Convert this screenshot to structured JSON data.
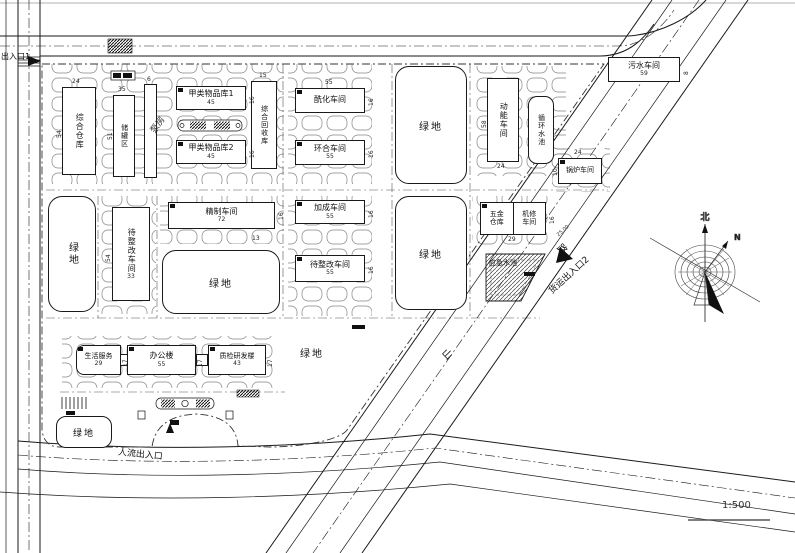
{
  "labels": {
    "green": "绿地",
    "scale": "1:500",
    "entrance1": "出入口1",
    "freight2": "货运出入口2",
    "pedestrian": "人流出入口",
    "road_char_shan": "山",
    "road_char_lu": "路",
    "elevation": "25.00",
    "north_char": "北",
    "north_n": "N",
    "emergency_pool": "应急水池"
  },
  "buildings": {
    "zonghecangku": {
      "name": "综合仓库",
      "w": "24",
      "h": "54"
    },
    "guanqu": {
      "name": "储罐区",
      "w": "35",
      "h": "51"
    },
    "bengfang": {
      "name": "泵房",
      "w": "6"
    },
    "jialei1": {
      "name": "甲类物品库1",
      "w": "45",
      "h": "16"
    },
    "jialei2": {
      "name": "甲类物品库2",
      "w": "45",
      "h": "16"
    },
    "huishouku": {
      "name": "综合回收库",
      "w": "15"
    },
    "xianhua": {
      "name": "酰化车间",
      "w": "55",
      "h": "16"
    },
    "huanhe": {
      "name": "环合车间",
      "w": "55",
      "h": "16"
    },
    "dongneng": {
      "name": "动能车间",
      "w": "24",
      "h": "58"
    },
    "xunhuan": {
      "name": "循环水池"
    },
    "guolu": {
      "name": "锅炉车间",
      "w": "24",
      "h": "10"
    },
    "wushui": {
      "name": "污水车间",
      "w": "59",
      "h": "8"
    },
    "daizhenggai_v": {
      "name": "待整改车间",
      "w": "33",
      "h": "54"
    },
    "jingzhi": {
      "name": "精制车间",
      "w": "72",
      "h": "16",
      "notch": "13"
    },
    "jiacheng": {
      "name": "加成车间",
      "w": "55",
      "h": "16"
    },
    "daizhenggai_h": {
      "name": "待整改车间",
      "w": "55",
      "h": "16"
    },
    "wujin": {
      "lines": [
        "五金",
        "仓库"
      ],
      "w": "29",
      "h": "16"
    },
    "jixiu": {
      "lines": [
        "机修",
        "车间"
      ]
    },
    "shenghuo": {
      "name": "生活服务",
      "w": "29",
      "h": "17"
    },
    "bangong": {
      "name": "办公楼",
      "w": "55",
      "h": "17"
    },
    "zhijian": {
      "name": "质检研发楼",
      "w": "43",
      "h": "17"
    }
  }
}
